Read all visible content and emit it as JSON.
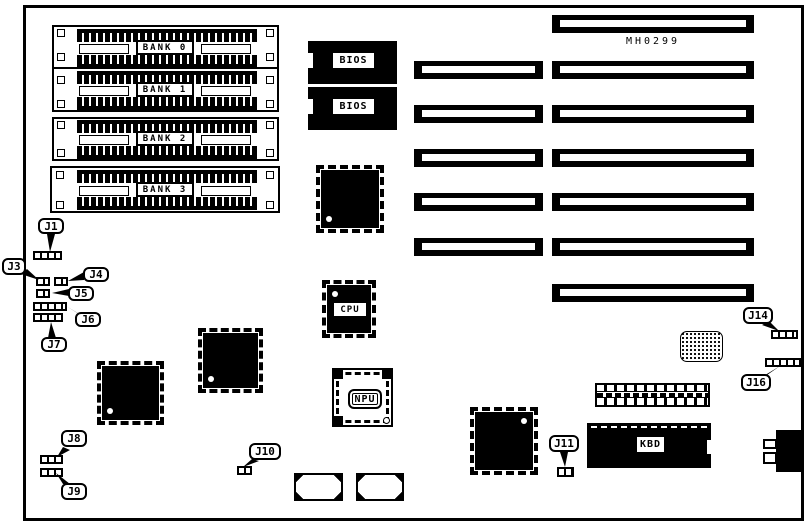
{
  "board": {
    "part_number": "MH0299",
    "ink_color": "#000000",
    "paper_color": "#ffffff"
  },
  "memory_banks": [
    {
      "label": "BANK 0"
    },
    {
      "label": "BANK 1"
    },
    {
      "label": "BANK 2"
    },
    {
      "label": "BANK 3"
    }
  ],
  "bios_chips": [
    {
      "label": "BIOS"
    },
    {
      "label": "BIOS"
    }
  ],
  "cpu": {
    "label": "CPU"
  },
  "npu": {
    "label": "NPU"
  },
  "keyboard_controller": {
    "label": "KBD"
  },
  "jumpers": {
    "j1": {
      "id": "J1"
    },
    "j3": {
      "id": "J3"
    },
    "j4": {
      "id": "J4"
    },
    "j5": {
      "id": "J5"
    },
    "j6": {
      "id": "J6"
    },
    "j7": {
      "id": "J7"
    },
    "j8": {
      "id": "J8"
    },
    "j9": {
      "id": "J9"
    },
    "j10": {
      "id": "J10"
    },
    "j11": {
      "id": "J11"
    },
    "j14": {
      "id": "J14"
    },
    "j16": {
      "id": "J16"
    }
  },
  "expansion_slots": {
    "right_column_count": 7,
    "left_column_count": 5
  }
}
